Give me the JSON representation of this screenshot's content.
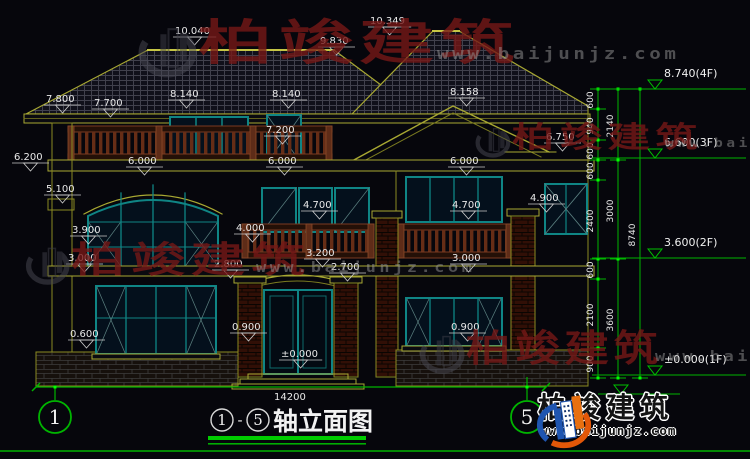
{
  "title": {
    "axis_start": "1",
    "separator": "-",
    "axis_end": "5",
    "caption": "轴立面图"
  },
  "bottom_logo": {
    "name": "柏竣建筑",
    "url": "www.baijunjz.com"
  },
  "watermark": {
    "name": "柏竣建筑",
    "url": "www.baijunjz.com",
    "instances": [
      {
        "x": 136,
        "y": 20,
        "font": 48,
        "sx": 1.55,
        "urlfont": 16
      },
      {
        "x": 24,
        "y": 242,
        "font": 36,
        "sx": 1.5,
        "urlfont": 14
      },
      {
        "x": 474,
        "y": 124,
        "font": 29,
        "sx": 1.45,
        "urlfont": 12
      },
      {
        "x": 418,
        "y": 330,
        "font": 37,
        "sx": 1.2,
        "urlfont": 14
      }
    ]
  },
  "axis_bubbles": [
    {
      "label": "1",
      "x": 55,
      "y": 417
    },
    {
      "label": "5",
      "x": 527,
      "y": 417
    }
  ],
  "drawing": {
    "labels": [
      {
        "text": "10.040",
        "x": 175,
        "y": 34
      },
      {
        "text": "9.830",
        "x": 320,
        "y": 44
      },
      {
        "text": "10.349",
        "x": 370,
        "y": 24
      },
      {
        "text": "8.140",
        "x": 170,
        "y": 97
      },
      {
        "text": "8.140",
        "x": 272,
        "y": 97
      },
      {
        "text": "8.158",
        "x": 450,
        "y": 95
      },
      {
        "text": "7.800",
        "x": 46,
        "y": 102
      },
      {
        "text": "7.700",
        "x": 94,
        "y": 106
      },
      {
        "text": "7.200",
        "x": 266,
        "y": 133
      },
      {
        "text": "6.200",
        "x": 14,
        "y": 160
      },
      {
        "text": "6.000",
        "x": 128,
        "y": 164
      },
      {
        "text": "6.000",
        "x": 268,
        "y": 164
      },
      {
        "text": "6.000",
        "x": 450,
        "y": 164
      },
      {
        "text": "6.750",
        "x": 546,
        "y": 140
      },
      {
        "text": "5.100",
        "x": 46,
        "y": 192
      },
      {
        "text": "4.700",
        "x": 303,
        "y": 208
      },
      {
        "text": "4.700",
        "x": 452,
        "y": 208
      },
      {
        "text": "4.900",
        "x": 530,
        "y": 201
      },
      {
        "text": "4.000",
        "x": 236,
        "y": 231
      },
      {
        "text": "3.900",
        "x": 72,
        "y": 233
      },
      {
        "text": "3.200",
        "x": 306,
        "y": 256
      },
      {
        "text": "3.000",
        "x": 68,
        "y": 261
      },
      {
        "text": "3.000",
        "x": 452,
        "y": 261
      },
      {
        "text": "2.800",
        "x": 214,
        "y": 267
      },
      {
        "text": "2.700",
        "x": 331,
        "y": 270
      },
      {
        "text": "0.900",
        "x": 232,
        "y": 330
      },
      {
        "text": "0.900",
        "x": 451,
        "y": 330
      },
      {
        "text": "0.600",
        "x": 70,
        "y": 337
      },
      {
        "text": "±0.000",
        "x": 281,
        "y": 357
      },
      {
        "text": "14200",
        "x": 274,
        "y": 400,
        "plain": true
      }
    ]
  },
  "right_chain": {
    "x_inner": 598,
    "x_mid": 618,
    "x_outer": 640,
    "top": 89,
    "bottom": 378,
    "inner_ticks": [
      89,
      109,
      140,
      160,
      180,
      259,
      279,
      348,
      378
    ],
    "mid_ticks": [
      89,
      160,
      259,
      378
    ],
    "outer_ticks": [
      89,
      378
    ],
    "inner_segments": [
      {
        "v": "600",
        "y": 100
      },
      {
        "v": "940",
        "y": 126
      },
      {
        "v": "600",
        "y": 151
      },
      {
        "v": "600",
        "y": 171
      },
      {
        "v": "2400",
        "y": 221
      },
      {
        "v": "600",
        "y": 270
      },
      {
        "v": "2100",
        "y": 315
      },
      {
        "v": "900",
        "y": 364
      }
    ],
    "mid_segments": [
      {
        "v": "2140",
        "y": 126
      },
      {
        "v": "3000",
        "y": 211
      },
      {
        "v": "3600",
        "y": 320
      }
    ],
    "outer_segments": [
      {
        "v": "8740",
        "y": 235
      }
    ],
    "levels": [
      {
        "text": "8.740(4F)",
        "y": 89
      },
      {
        "text": "6.600(3F)",
        "y": 158
      },
      {
        "text": "3.600(2F)",
        "y": 258
      },
      {
        "text": "±0.000(1F)",
        "y": 375
      }
    ],
    "sub_marker_y": 394
  },
  "colors": {
    "background": "#06060c",
    "wall_line": "#a8a832",
    "window_frame": "#0f8585",
    "railing": "#6b3018",
    "dimension_green": "#00b400",
    "text_white": "#e8e8e8",
    "watermark_red": "#761816"
  }
}
